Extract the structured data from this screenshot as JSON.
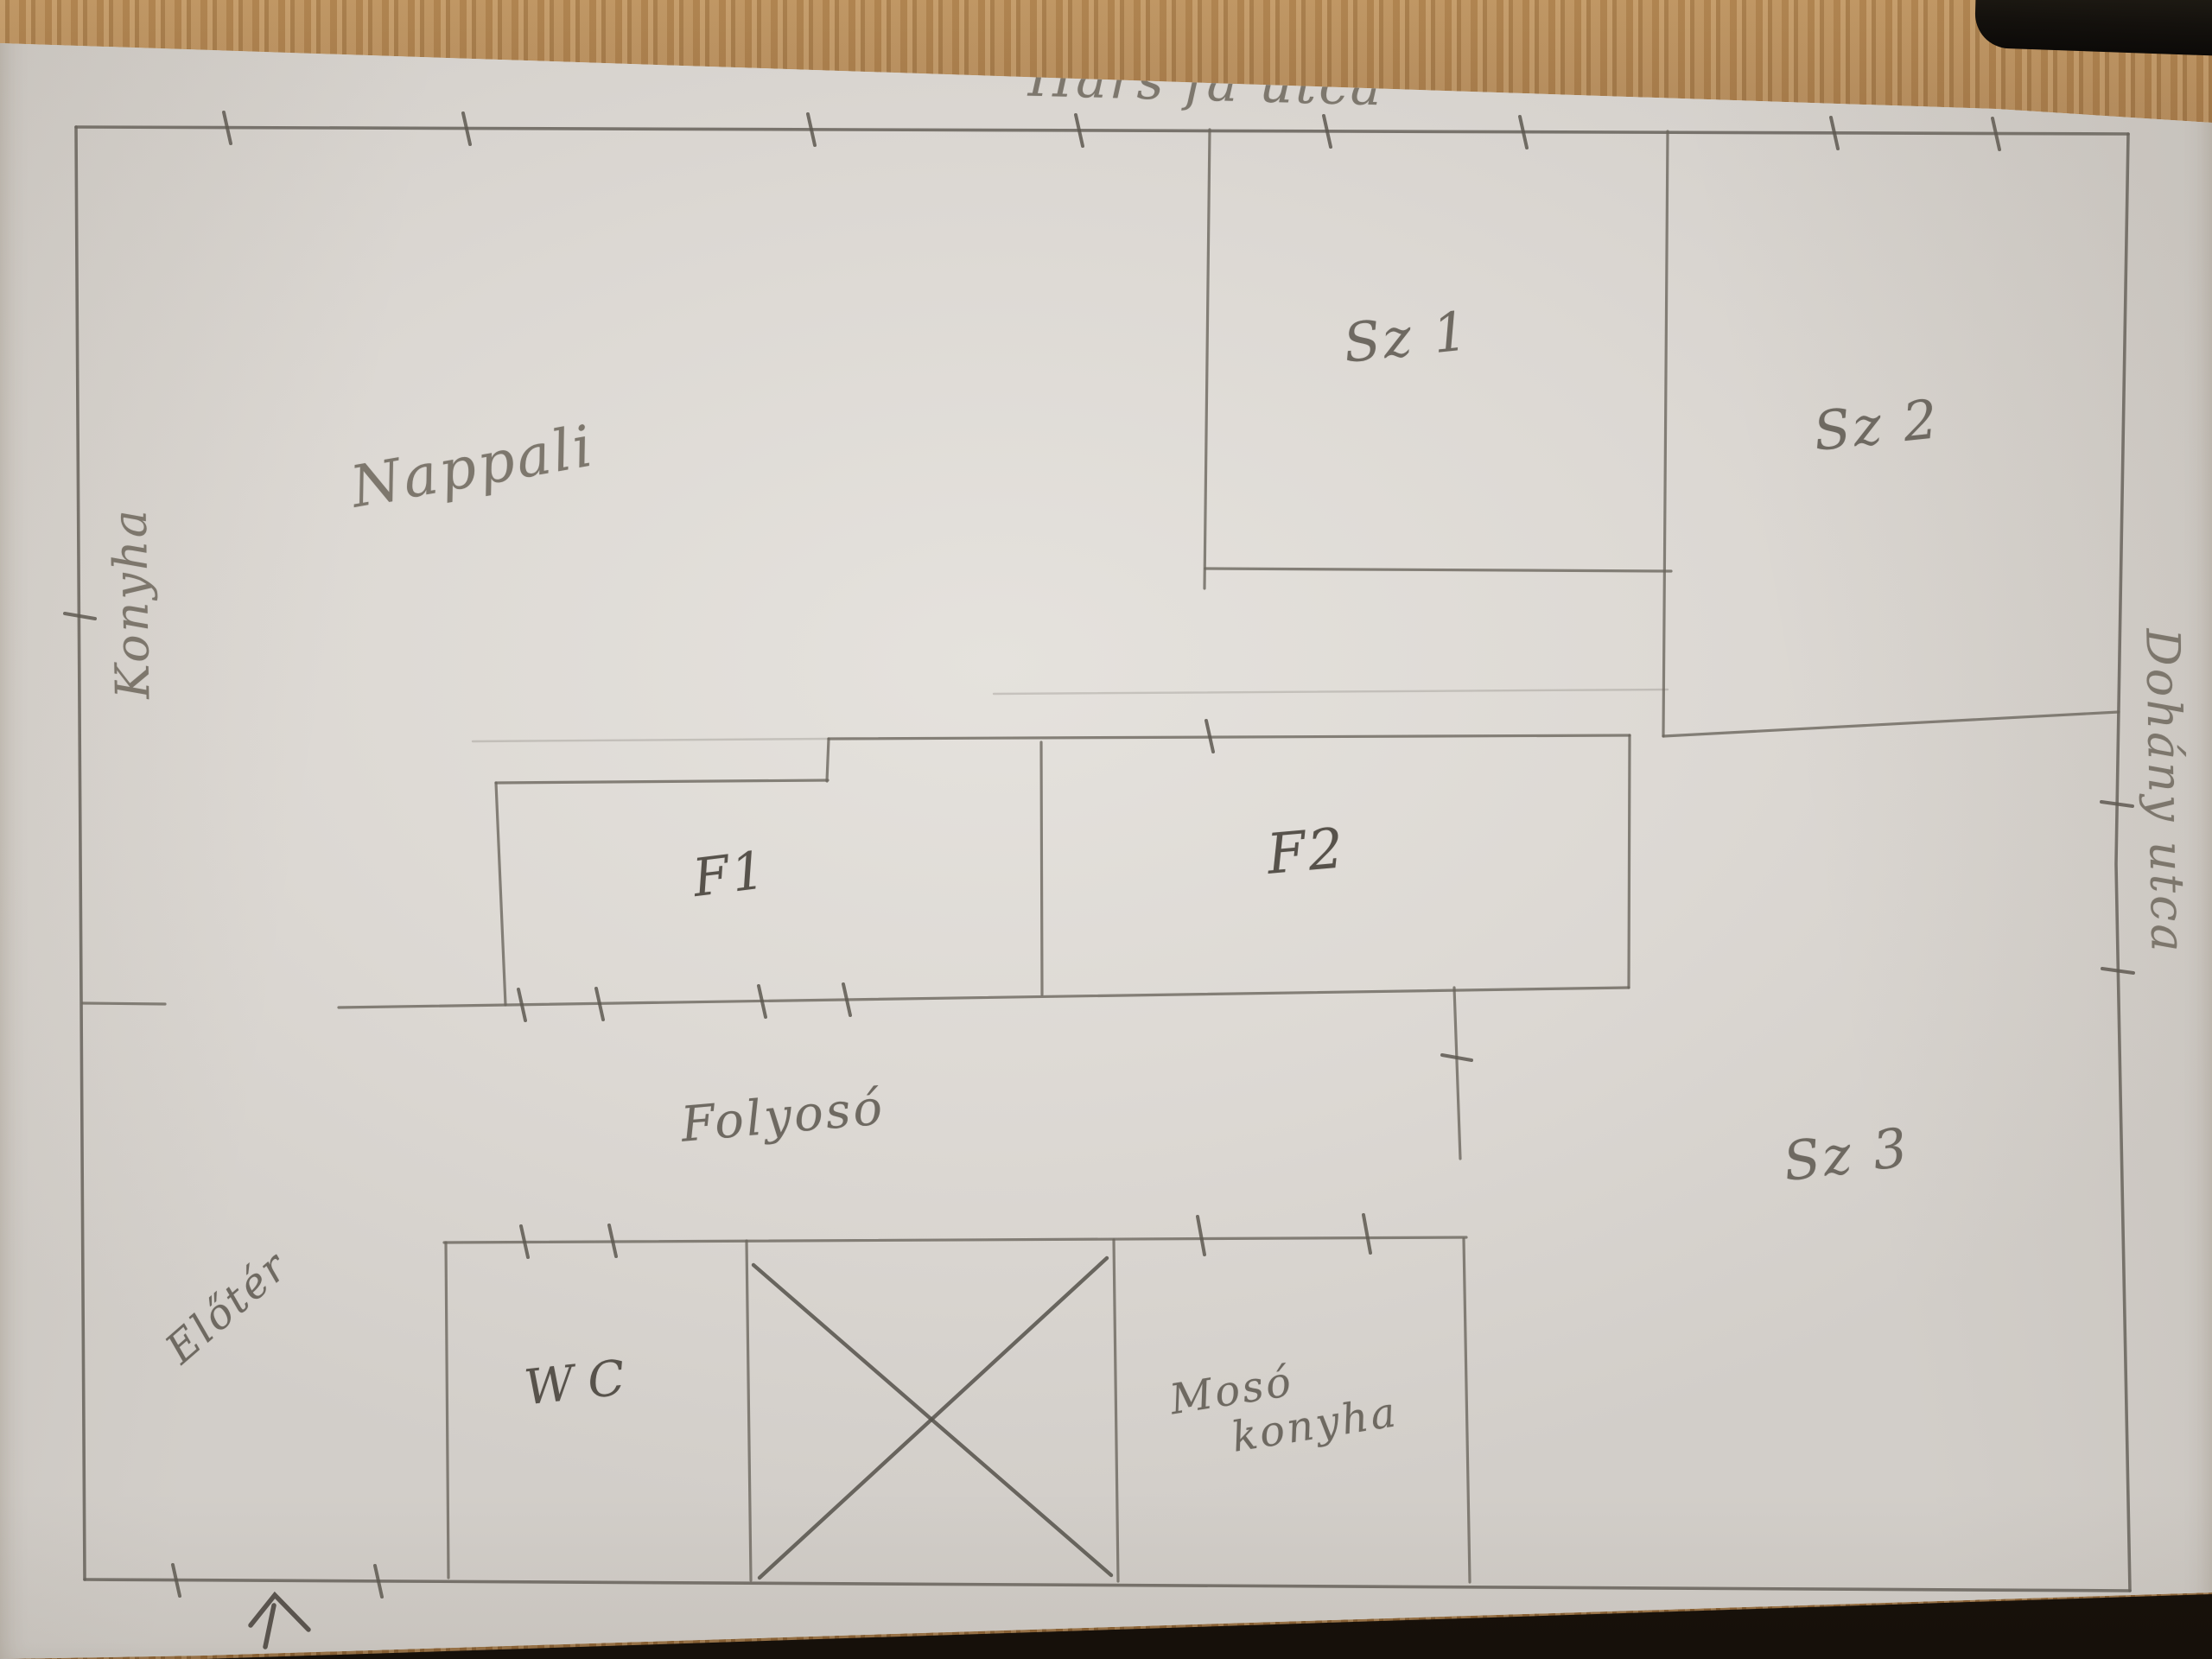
{
  "plan": {
    "streets": {
      "top": "Hárs fa utca",
      "right": "Dohány utca"
    },
    "rooms": {
      "nappali": "Nappali",
      "konyha": "Konyha",
      "sz1": "Sz 1",
      "sz2": "Sz 2",
      "sz3": "Sz 3",
      "f1": "F1",
      "f2": "F2",
      "folyoso": "Folyosó",
      "eloter": "Előtér",
      "wc": "WC",
      "moso_line1": "Mosó",
      "moso_line2": "konyha"
    },
    "markers": {
      "entrance_arrow": "up-arrow at bottom entrance",
      "crossed_box": "x-crossed shaft box",
      "wall_ticks": "short door/window tick marks crossing walls"
    },
    "colors": {
      "pencil": "#6b665e",
      "paper": "#dcd8d3",
      "wood": "#a97e4e",
      "bottom_shadow": "#16100a",
      "dark_object": "#14110d"
    }
  }
}
